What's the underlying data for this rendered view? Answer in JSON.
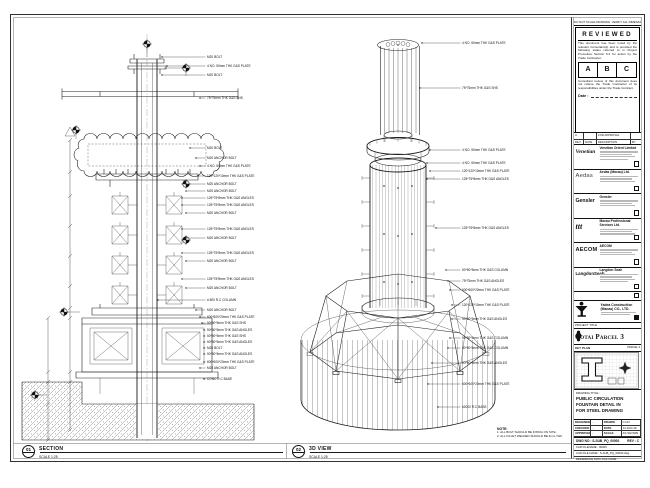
{
  "section_view": {
    "badge": "01",
    "title": "SECTION",
    "scale": "SCALE 1:25",
    "annotations": [
      {
        "y": 57,
        "x0": 162,
        "label": "M20 BOLT"
      },
      {
        "y": 66,
        "x0": 167,
        "label": "4 NO. 50mm THK G&S PLATE"
      },
      {
        "y": 75,
        "x0": 162,
        "label": "M20 BOLT"
      },
      {
        "y": 98,
        "x0": 200,
        "label": "75*75mm THK G&S SHS"
      },
      {
        "y": 148,
        "x0": 190,
        "label": "M20 BOLT"
      },
      {
        "y": 158,
        "x0": 196,
        "label": "M20 ANCHOR BOLT"
      },
      {
        "y": 166,
        "x0": 200,
        "label": "4 NO. 50mm THK G&S PLATE"
      },
      {
        "y": 176,
        "x0": 198,
        "label": "120*120*10mm THK G&S PLATE"
      },
      {
        "y": 184,
        "x0": 186,
        "label": "M20 ANCHOR BOLT"
      },
      {
        "y": 191,
        "x0": 186,
        "label": "M20 ANCHOR BOLT"
      },
      {
        "y": 198,
        "x0": 182,
        "label": "125*75*8mm THK G&S ANGLES"
      },
      {
        "y": 205,
        "x0": 182,
        "label": "125*75*8mm THK G&S ANGLES"
      },
      {
        "y": 213,
        "x0": 186,
        "label": "M20 ANCHOR BOLT"
      },
      {
        "y": 229,
        "x0": 182,
        "label": "125*75*8mm THK G&S ANGLES"
      },
      {
        "y": 238,
        "x0": 186,
        "label": "M20 ANCHOR BOLT"
      },
      {
        "y": 253,
        "x0": 182,
        "label": "125*75*8mm THK G&S ANGLES"
      },
      {
        "y": 261,
        "x0": 186,
        "label": "M20 ANCHOR BOLT"
      },
      {
        "y": 279,
        "x0": 182,
        "label": "125*75*8mm THK G&S ANGLES"
      },
      {
        "y": 288,
        "x0": 186,
        "label": "M20 ANCHOR BOLT"
      },
      {
        "y": 300,
        "x0": 158,
        "label": "# 800 R.C COLUMN"
      },
      {
        "y": 310,
        "x0": 196,
        "label": "M20 ANCHOR BOLT"
      },
      {
        "y": 317,
        "x0": 200,
        "label": "600*600*20mm THK G&S PLATE"
      },
      {
        "y": 323,
        "x0": 202,
        "label": "50*50*5mm THK G&S SHS"
      },
      {
        "y": 330,
        "x0": 204,
        "label": "50*50*5mm THK G&S ANGLES"
      },
      {
        "y": 336,
        "x0": 204,
        "label": "50*50*5mm THK G&S SHS"
      },
      {
        "y": 342,
        "x0": 204,
        "label": "50*50*5mm THK G&S ANGLES"
      },
      {
        "y": 348,
        "x0": 204,
        "label": "M20 BOLT"
      },
      {
        "y": 354,
        "x0": 204,
        "label": "50*50*5mm THK G&S ANGLES"
      },
      {
        "y": 362,
        "x0": 204,
        "label": "600*600*20mm THK G&S PLATE"
      },
      {
        "y": 368,
        "x0": 200,
        "label": "M20 ANCHOR BOLT"
      },
      {
        "y": 379,
        "x0": 204,
        "label": "CONC R.C BASE"
      }
    ]
  },
  "iso_view": {
    "badge": "02",
    "title": "3D VIEW",
    "scale": "SCALE 1:25",
    "annotations": [
      {
        "y": 43,
        "x0": 422,
        "label": "4 NO. 50mm THK G&S PLATE"
      },
      {
        "y": 88,
        "x0": 420,
        "label": "75*75mm THK G&S SHS"
      },
      {
        "y": 150,
        "x0": 430,
        "label": "4 NO. 50mm THK G&S PLATE"
      },
      {
        "y": 163,
        "x0": 427,
        "label": "4 NO. 50mm THK G&S PLATE"
      },
      {
        "y": 171,
        "x0": 430,
        "label": "120*120*10mm THK G&S PLATE"
      },
      {
        "y": 179,
        "x0": 427,
        "label": "125*75*8mm THK G&S ANGLES"
      },
      {
        "y": 228,
        "x0": 436,
        "label": "125*75*8mm THK G&S ANGLES"
      },
      {
        "y": 270,
        "x0": 446,
        "label": "50*50*5mm THK G&S COLUMN"
      },
      {
        "y": 281,
        "x0": 448,
        "label": "75*75mm THK G&S ANGLES"
      },
      {
        "y": 290,
        "x0": 450,
        "label": "600*600*20mm THK G&S PLATE"
      },
      {
        "y": 305,
        "x0": 452,
        "label": "120*120*10mm THK G&S PLATE"
      },
      {
        "y": 319,
        "x0": 452,
        "label": "50*50*5mm THK G&S ANGLES"
      },
      {
        "y": 338,
        "x0": 450,
        "label": "50*50*5mm THK G&S COLUMN"
      },
      {
        "y": 348,
        "x0": 448,
        "label": "50*50*5mm THK G&S COLUMN"
      },
      {
        "y": 363,
        "x0": 432,
        "label": "50*50*5mm THK G&S ANGLES"
      },
      {
        "y": 384,
        "x0": 428,
        "label": "600*600*20mm THK G&S PLATE"
      },
      {
        "y": 407,
        "x0": 438,
        "label": "#2000 R.C BASE"
      }
    ]
  },
  "notes": {
    "heading": "NOTE:",
    "items": [
      "1. ALL BOLT SHOULD BE FIXING ON SITE.",
      "2. ALL FILLET WELDED SHOULD BE 6mm THK."
    ]
  },
  "title_block": {
    "disclaimer": "DO NOT SCALE DRAWING. VERIFY ALL DIMENSIONS ON SITE.",
    "reviewed": {
      "title": "REVIEWED",
      "para1": "This document has been noted by the relevant Consultant(s) and is provided the following status referred to in Project Procedure Section 5.4 for action by the Trade Contractor.",
      "statuses": [
        "A",
        "B",
        "C"
      ],
      "para2": "Consultant review of this document does not relieve the Trade Contractor of its responsibilities under the Trade Contract.",
      "date_label": "Date :"
    },
    "rev_table": {
      "row": [
        "A",
        "",
        "FOR APPROVAL",
        ""
      ],
      "headers": [
        "REV",
        "DATE",
        "DESCRIPTION",
        "BY"
      ]
    },
    "consultants": [
      {
        "logo": "Venetian",
        "style": "lg-venetian",
        "name": "Venetian Orient Limited",
        "bars": 4,
        "filled": false
      },
      {
        "logo": "Aedas",
        "style": "lg-aedas",
        "name": "Aedas (Macau) Ltd.",
        "bars": 3,
        "filled": false
      },
      {
        "logo": "Gensler",
        "style": "lg-gensler",
        "name": "Gensler",
        "bars": 3,
        "filled": false
      },
      {
        "logo": "ttt",
        "style": "lg-ttt",
        "name": "Macau Professional Services Ltd.",
        "bars": 3,
        "filled": false
      },
      {
        "logo": "AECOM",
        "style": "lg-aecom",
        "name": "AECOM",
        "bars": 3,
        "filled": false
      },
      {
        "logo": "LangdonSeah",
        "style": "lg-langdon",
        "name": "Langdon Seah",
        "bars": 4,
        "filled": false
      }
    ],
    "contractor": {
      "name": "Yadea Construction (Macau) CO., LTD."
    },
    "project": {
      "label": "PROJECT TITLE",
      "title": "Cotai Parcel 3"
    },
    "key_plan": {
      "label": "KEY PLAN",
      "sub": "PARCEL 3"
    },
    "drawing_title": {
      "label": "DRAWING TITLE :",
      "lines": [
        "PUBLIC CIRCULATION",
        "FOUNTAIN DETAIL IN",
        "FOR STEEL DRAWING"
      ]
    },
    "signoff": {
      "rows": [
        [
          "DESIGNED",
          "-",
          "DRAWN",
          "C.HO"
        ],
        [
          "CHECKED",
          "-",
          "DATE",
          "14-JUN-16"
        ],
        [
          "APPROVED",
          "-",
          "SCALE",
          "AS SHOWN"
        ]
      ]
    },
    "dwg": {
      "label": "DWG NO :",
      "value": "S-SUB_PQ_00000",
      "rev_label": "REV :",
      "rev": "C"
    },
    "file_rows": [
      "CAD FILENAME : 00000",
      "CAD FILE NAME : S-SUB_PQ_00000.dwg",
      "REFERENCE DWG FILE NAME :"
    ]
  }
}
